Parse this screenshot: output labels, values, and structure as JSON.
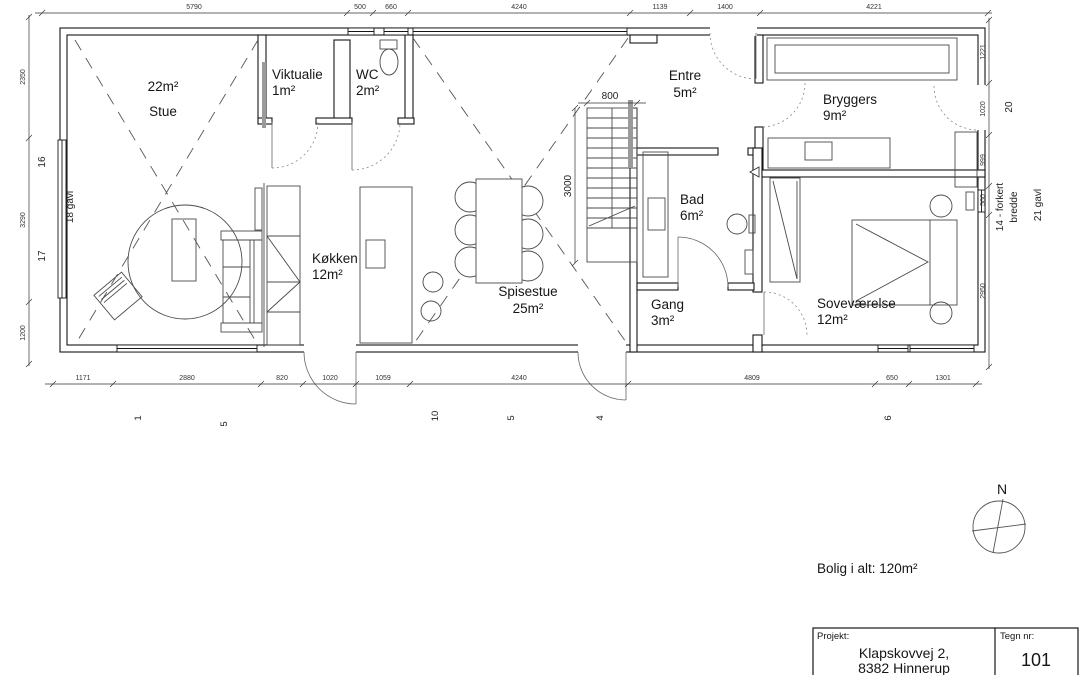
{
  "rooms": {
    "stue": {
      "area": "22m²",
      "name": "Stue"
    },
    "viktualie": {
      "name": "Viktualie",
      "area": "1m²"
    },
    "wc": {
      "name": "WC",
      "area": "2m²"
    },
    "entre": {
      "name": "Entre",
      "area": "5m²"
    },
    "bryggers": {
      "name": "Bryggers",
      "area": "9m²"
    },
    "kokken": {
      "name": "Køkken",
      "area": "12m²"
    },
    "spisestue": {
      "name": "Spisestue",
      "area": "25m²"
    },
    "bad": {
      "name": "Bad",
      "area": "6m²"
    },
    "gang": {
      "name": "Gang",
      "area": "3m²"
    },
    "sovevaerelse": {
      "name": "Soveværelse",
      "area": "12m²"
    }
  },
  "dims": {
    "top": [
      "5790",
      "500",
      "660",
      "4240",
      "1139",
      "1400",
      "4221"
    ],
    "bottom": [
      "1171",
      "2880",
      "820",
      "1020",
      "1059",
      "4240",
      "4809",
      "650",
      "1301"
    ],
    "left": [
      "2350",
      "3290",
      "1200"
    ],
    "right": [
      "1221",
      "1020",
      "999",
      "560",
      "2950"
    ],
    "stair_width": "800",
    "stair_length": "3000"
  },
  "marks": {
    "left_side": [
      "16",
      "17"
    ],
    "right_side": [
      "20"
    ],
    "bottom": [
      "1",
      "5",
      "10",
      "5",
      "4",
      "6"
    ],
    "gavl_left": "18 gavl",
    "gavl_right": "21 gavl",
    "note_right_1": "14 - forkert",
    "note_right_2": "bredde"
  },
  "summary": {
    "total_label": "Bolig i alt: 120m²"
  },
  "compass": {
    "north": "N"
  },
  "title_block": {
    "project_label": "Projekt:",
    "address_line1": "Klapskovvej 2,",
    "address_line2": "8382 Hinnerup",
    "drawing_no_label": "Tegn nr:",
    "drawing_no": "101"
  }
}
